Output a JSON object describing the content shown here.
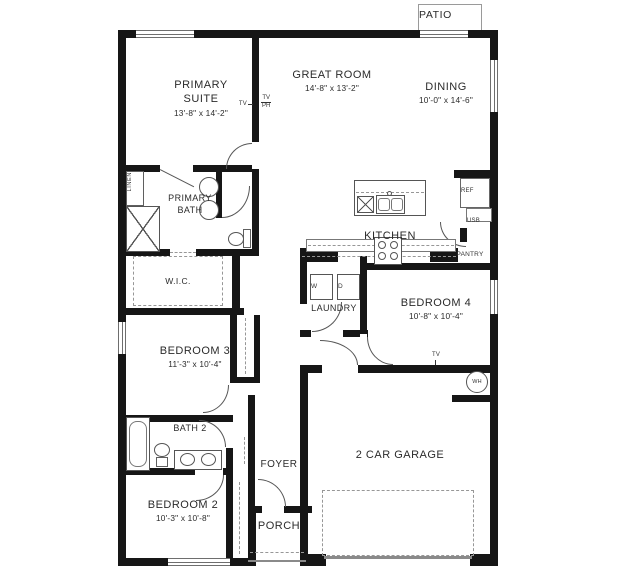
{
  "rooms": {
    "patio": {
      "name": "PATIO"
    },
    "primary_suite": {
      "name": "PRIMARY SUITE",
      "dims": "13'-8\" x 14'-2\""
    },
    "great_room": {
      "name": "GREAT ROOM",
      "dims": "14'-8\" x 13'-2\""
    },
    "dining": {
      "name": "DINING",
      "dims": "10'-0\" x 14'-6\""
    },
    "primary_bath": {
      "name": "PRIMARY BATH"
    },
    "kitchen": {
      "name": "KITCHEN"
    },
    "pantry": {
      "name": "PANTRY"
    },
    "wic": {
      "name": "W.I.C."
    },
    "laundry": {
      "name": "LAUNDRY"
    },
    "bedroom_4": {
      "name": "BEDROOM 4",
      "dims": "10'-8\" x 10'-4\""
    },
    "bedroom_3": {
      "name": "BEDROOM 3",
      "dims": "11'-3\" x 10'-4\""
    },
    "bath_2": {
      "name": "BATH 2"
    },
    "bedroom_2": {
      "name": "BEDROOM 2",
      "dims": "10'-3\" x 10'-8\""
    },
    "foyer": {
      "name": "FOYER"
    },
    "porch": {
      "name": "PORCH"
    },
    "garage": {
      "name": "2 CAR GARAGE"
    }
  },
  "labels": {
    "linen": "LINEN",
    "ref": "REF",
    "usb": "USB",
    "washer": "W",
    "dryer": "D",
    "water_heater": "WH",
    "tv_wall_left": "TV",
    "tv_wall_right_top": "TV",
    "tv_wall_right_bottom": "PH",
    "tv_garage": "TV"
  },
  "colors": {
    "wall": "#161616",
    "line_gray": "#6e6e6e",
    "dash_gray": "#979797",
    "text": "#2b2b2b",
    "background": "#ffffff"
  }
}
